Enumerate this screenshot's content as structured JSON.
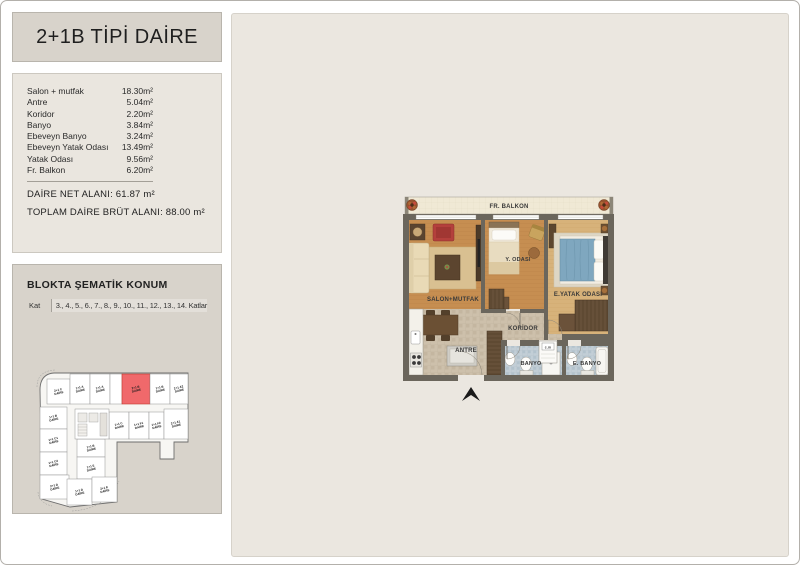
{
  "page": {
    "title": "2+1B TİPİ DAİRE"
  },
  "areas": {
    "rows": [
      {
        "label": "Salon + mutfak",
        "value": "18.30m²"
      },
      {
        "label": "Antre",
        "value": "5.04m²"
      },
      {
        "label": "Koridor",
        "value": "2.20m²"
      },
      {
        "label": "Banyo",
        "value": "3.84m²"
      },
      {
        "label": "Ebeveyn Banyo",
        "value": "3.24m²"
      },
      {
        "label": "Ebeveyn Yatak Odası",
        "value": "13.49m²"
      },
      {
        "label": "Yatak Odası",
        "value": "9.56m²"
      },
      {
        "label": "Fr. Balkon",
        "value": "6.20m²"
      }
    ],
    "net_label": "DAİRE NET ALANI:",
    "net_value": "61.87 m²",
    "brut_label": "TOPLAM DAİRE BRÜT ALANI:",
    "brut_value": "88.00 m²"
  },
  "location": {
    "title": "BLOKTA ŞEMATİK KONUM",
    "kat_label": "Kat",
    "kat_value": "3., 4., 5., 6., 7., 8., 9., 10., 11., 12., 13., 14. Katlar",
    "highlight_color": "#f0696b",
    "unit_suffix": "DAİRE",
    "units": [
      {
        "x": 45,
        "y": 377,
        "w": 23,
        "h": 25,
        "label": "2+1 C"
      },
      {
        "x": 68,
        "y": 372,
        "w": 20,
        "h": 30,
        "label": "1+1 A"
      },
      {
        "x": 88,
        "y": 372,
        "w": 20,
        "h": 30,
        "label": "1+1 A"
      },
      {
        "x": 108,
        "y": 372,
        "w": 12,
        "h": 30,
        "label": ""
      },
      {
        "x": 120,
        "y": 372,
        "w": 28,
        "h": 30,
        "label": "2+1 B",
        "highlight": true
      },
      {
        "x": 148,
        "y": 372,
        "w": 20,
        "h": 30,
        "label": "1+1 B"
      },
      {
        "x": 168,
        "y": 372,
        "w": 18,
        "h": 30,
        "label": "2+1 A2"
      },
      {
        "x": 107,
        "y": 410,
        "w": 20,
        "h": 27,
        "label": "1+1 C"
      },
      {
        "x": 127,
        "y": 410,
        "w": 20,
        "h": 27,
        "label": "1+1 F1"
      },
      {
        "x": 147,
        "y": 410,
        "w": 15,
        "h": 27,
        "label": "1+1 F2"
      },
      {
        "x": 162,
        "y": 407,
        "w": 24,
        "h": 30,
        "label": "2+1 A1"
      },
      {
        "x": 38,
        "y": 405,
        "w": 27,
        "h": 22,
        "label": "1+1 B"
      },
      {
        "x": 38,
        "y": 427,
        "w": 27,
        "h": 23,
        "label": "1+1 C1"
      },
      {
        "x": 38,
        "y": 450,
        "w": 27,
        "h": 23,
        "label": "1+1 C2"
      },
      {
        "x": 38,
        "y": 473,
        "w": 29,
        "h": 24,
        "label": "2+1 D"
      },
      {
        "x": 75,
        "y": 437,
        "w": 28,
        "h": 18,
        "label": "1+1 B"
      },
      {
        "x": 75,
        "y": 455,
        "w": 28,
        "h": 22,
        "label": "1+1 E"
      },
      {
        "x": 65,
        "y": 477,
        "w": 25,
        "h": 26,
        "label": "1+1 D"
      },
      {
        "x": 90,
        "y": 475,
        "w": 25,
        "h": 25,
        "label": "2+1 E"
      }
    ]
  },
  "floorplan": {
    "rooms": {
      "balkon": "FR. BALKON",
      "salon": "SALON+MUTFAK",
      "y_odasi": "Y. ODASI",
      "e_yatak": "E.YATAK ODASI",
      "koridor": "KORİDOR",
      "antre": "ANTRE",
      "banyo": "BANYO",
      "cm": "c.m",
      "e_banyo": "E. BANYO"
    }
  }
}
